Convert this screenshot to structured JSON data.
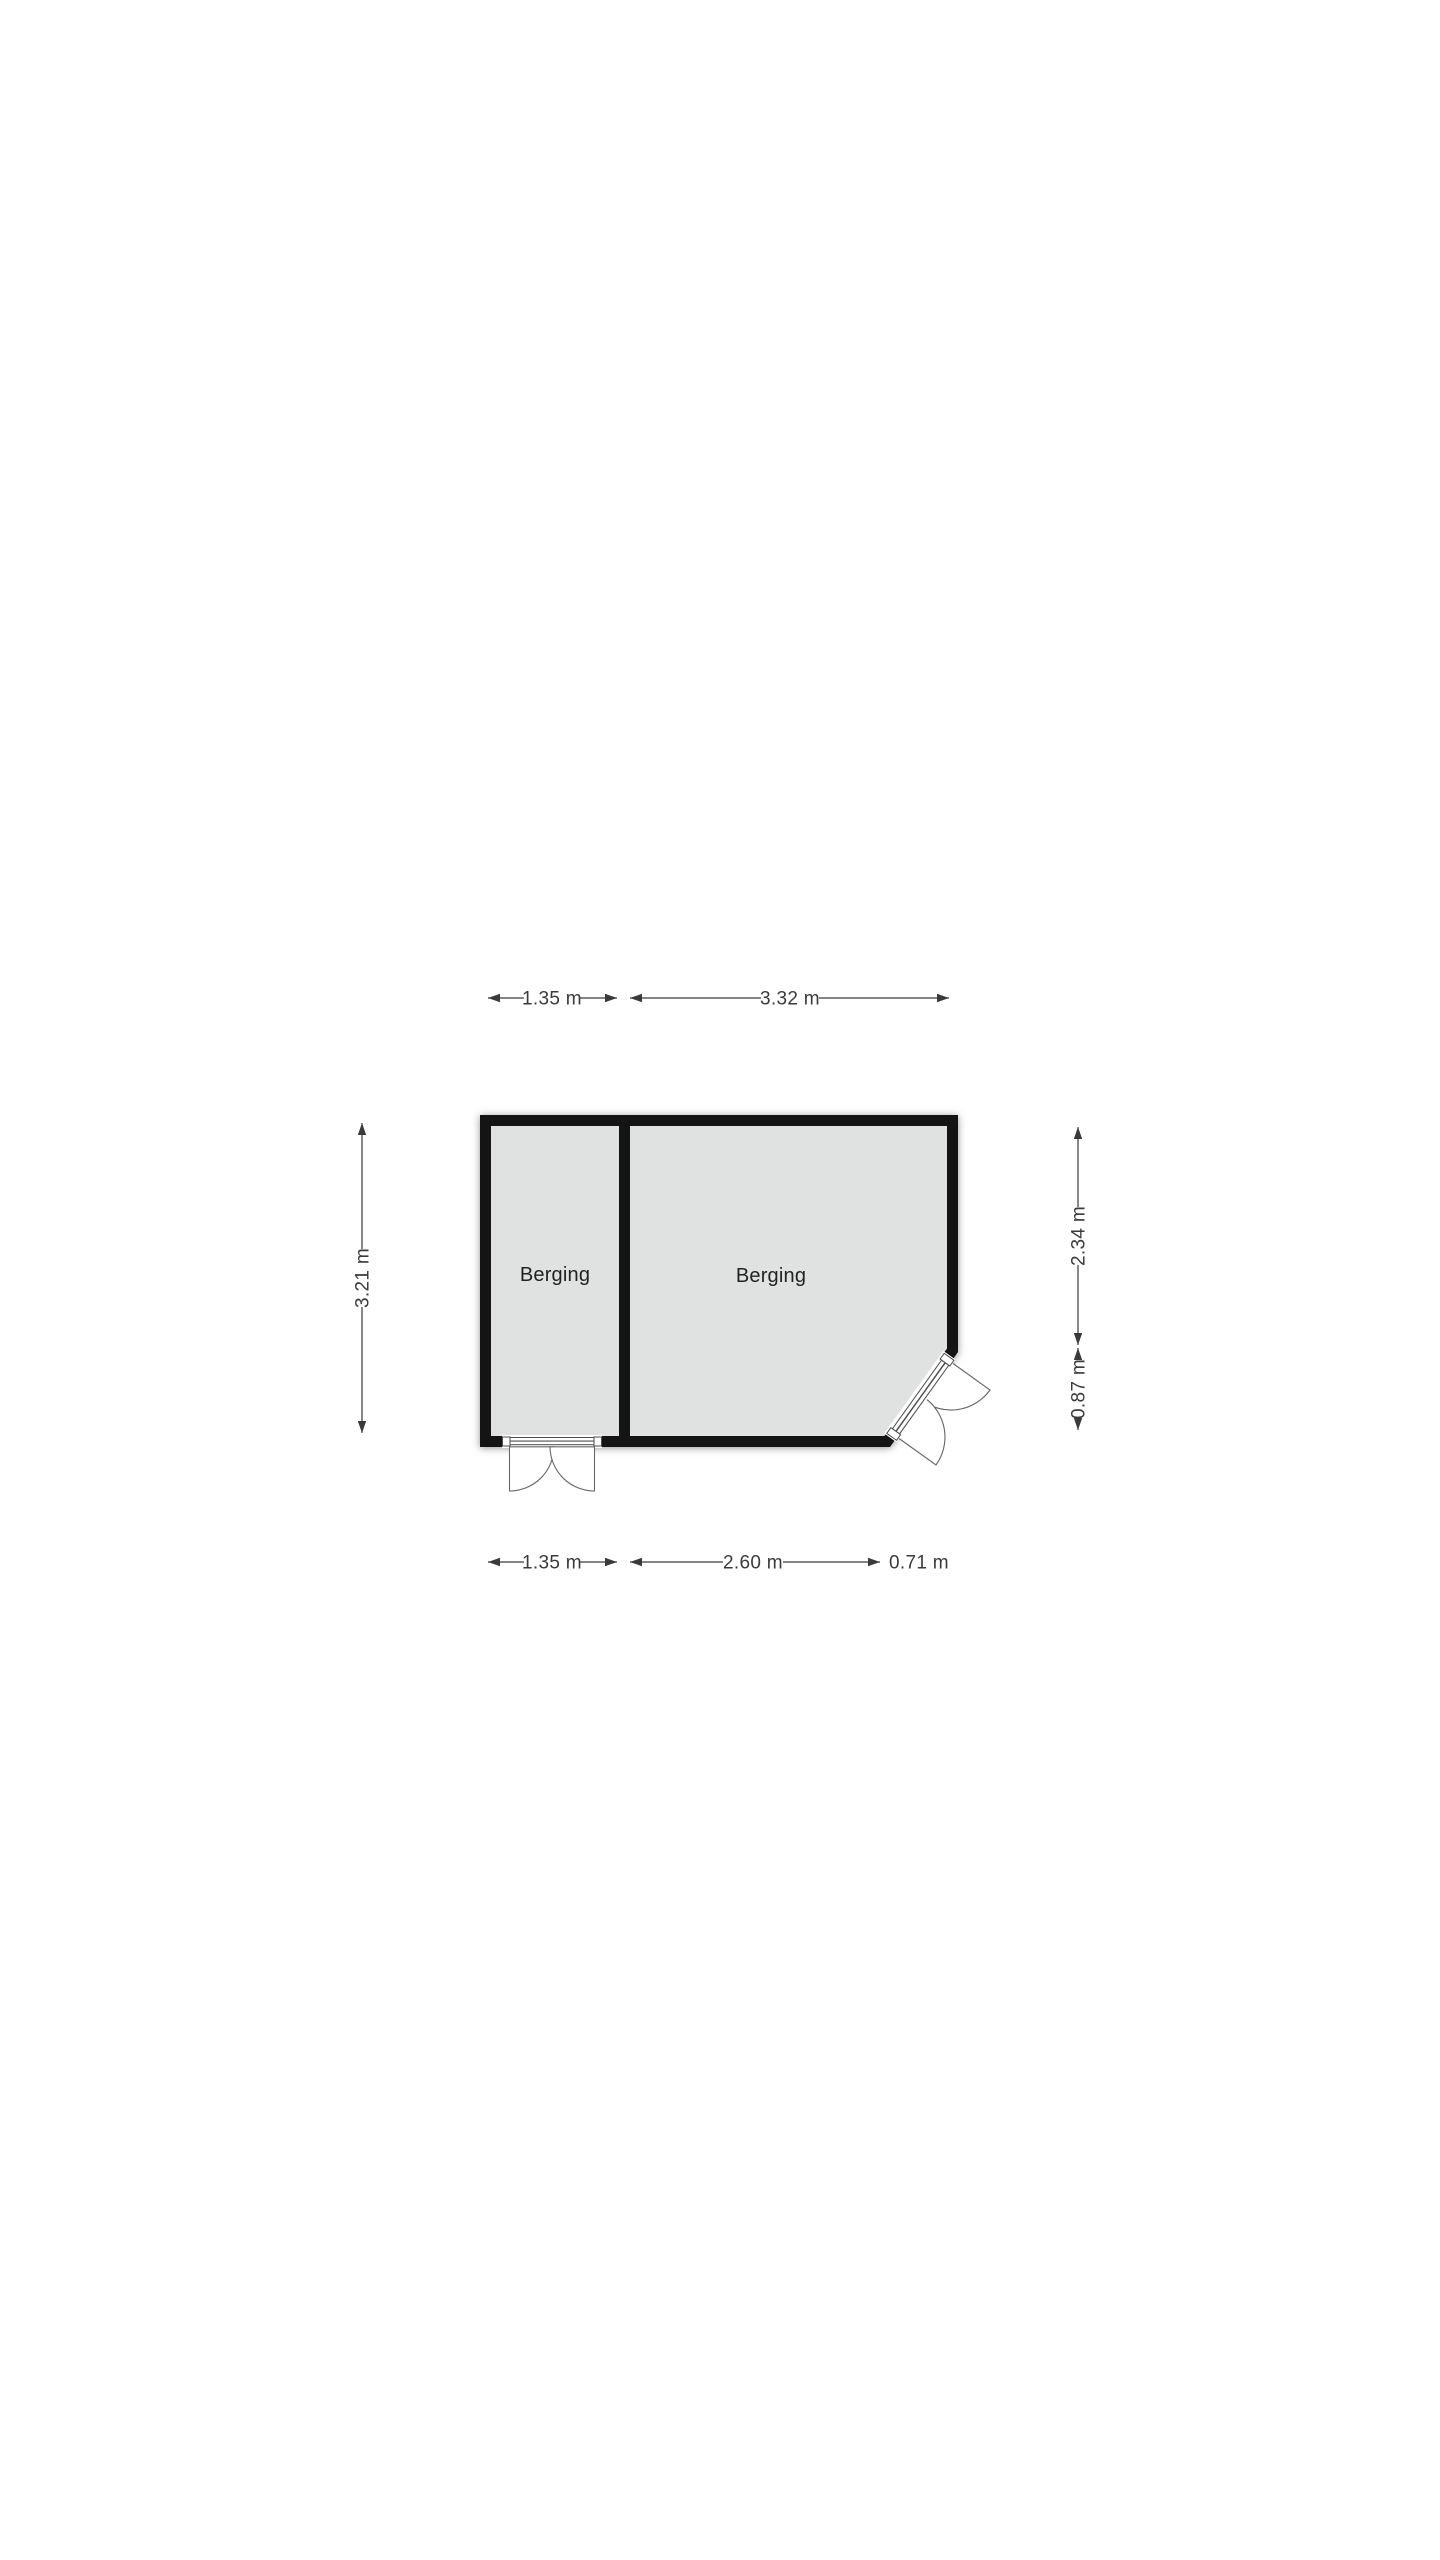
{
  "page": {
    "background": "#ffffff"
  },
  "floorplan": {
    "type": "floor-plan",
    "rooms": [
      {
        "label": "Berging"
      },
      {
        "label": "Berging"
      }
    ],
    "dimensions": {
      "top": [
        {
          "label": "1.35 m"
        },
        {
          "label": "3.32 m"
        }
      ],
      "bottom": [
        {
          "label": "1.35 m"
        },
        {
          "label": "2.60 m"
        },
        {
          "label": "0.71 m"
        }
      ],
      "left": [
        {
          "label": "3.21 m"
        }
      ],
      "right": [
        {
          "label": "2.34 m"
        },
        {
          "label": "0.87 m"
        }
      ]
    },
    "colors": {
      "wall": "#141414",
      "room_fill": "#e0e2e2",
      "dimension": "#3a3a3a",
      "room_label": "#222222",
      "door": "#555555",
      "background": "#ffffff"
    }
  }
}
